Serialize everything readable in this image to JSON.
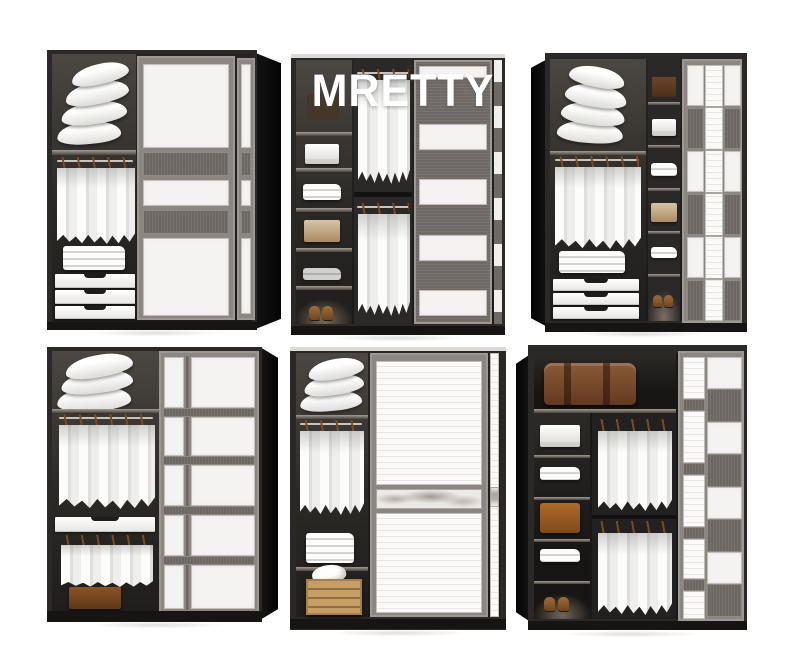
{
  "brand": {
    "watermark": "MRETTY"
  },
  "background_color": "#ffffff",
  "grid": {
    "rows": 2,
    "cols": 3
  },
  "palette": {
    "cabinet_frame": "#2b2928",
    "interior_dark": "#23211f",
    "door_frame_grey": "#8b8682",
    "woodgrain_grey": "#6d6763",
    "panel_white": "#f4f3f1",
    "hanger_brown": "#7a4a20",
    "box_tan": "#c2a379",
    "box_brown": "#8a5a33",
    "crate_wood": "#c59e66"
  },
  "tiles": [
    {
      "id": "wardrobe-top-left",
      "row": 1,
      "col": 1,
      "description": "Dark wardrobe with white sliding door panels and two grey woodgrain bands; open left side shows stacked pillows, hanging white shirts, folded clothes and three white drawers",
      "door_pattern": "large white panels with horizontal woodgrain bands",
      "contents": [
        "pillow stack",
        "hanging shirts",
        "folded clothes",
        "three drawers"
      ]
    },
    {
      "id": "wardrobe-top-middle",
      "row": 1,
      "col": 2,
      "description": "Wardrobe with MRETTY watermark; left shelf column with boxes, towels and shoes, two rows of hanging shirts, grey woodgrain door with white horizontal bands",
      "door_pattern": "grey woodgrain with four white horizontal bands",
      "contents": [
        "storage boxes",
        "folded towel",
        "hanging shirts (two rows)",
        "shoes"
      ]
    },
    {
      "id": "wardrobe-top-right",
      "row": 1,
      "col": 3,
      "description": "Wardrobe with checkerboard sliding door of white and grey woodgrain squares around a ribbed white centre column; open side with pillows, shirts, linens, drawers and a shelf column with boxes and shoes",
      "door_pattern": "checkerboard squares with ribbed centre column",
      "contents": [
        "pillow stack",
        "hanging shirts",
        "folded linens",
        "three drawers",
        "boxes",
        "shoes"
      ]
    },
    {
      "id": "wardrobe-bottom-left",
      "row": 2,
      "col": 1,
      "description": "Dark wardrobe, right door a grid of white panels in two columns and five rows separated by woodgrain bands; open left side with pillows, two tiers of hanging shirts, a white drawer and a brown box",
      "door_pattern": "5-row two-column white panel grid",
      "contents": [
        "pillow stack",
        "hanging shirts (two tiers)",
        "white drawer",
        "brown box"
      ]
    },
    {
      "id": "wardrobe-bottom-middle",
      "row": 2,
      "col": 2,
      "description": "Wardrobe with large ribbed white door panels split by a marble-textured band; left column holds pillows, hanging shirts, folded linens and a wooden crate with white cloth",
      "door_pattern": "two large ribbed white panels with marble band",
      "contents": [
        "pillow stack",
        "hanging shirts",
        "folded linens",
        "wooden crate with cloth"
      ]
    },
    {
      "id": "wardrobe-bottom-right",
      "row": 2,
      "col": 3,
      "description": "Dark wardrobe interior with vintage trunk on top shelf, shelf column with towels, boxes and boots, two rows of hanging shirts, and a door of alternating white and woodgrain blocks beside a ribbed strip",
      "door_pattern": "alternating white/woodgrain blocks with ribbed strip",
      "contents": [
        "vintage trunk",
        "towels",
        "storage boxes",
        "boots",
        "hanging shirts (two rows)"
      ]
    }
  ]
}
